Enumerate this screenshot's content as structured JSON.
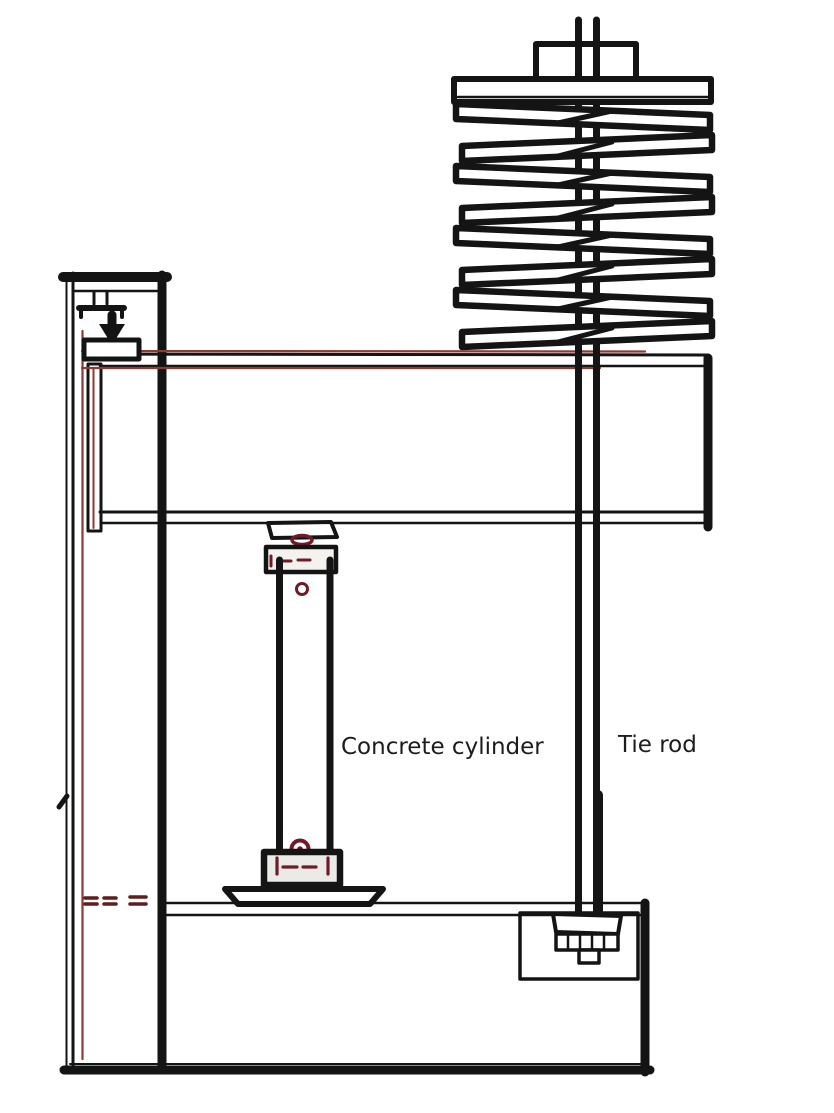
{
  "diagram": {
    "type": "engineering-sketch",
    "subject": "Creep test rig for a concrete cylinder with spring-loaded tie rod",
    "labels": {
      "concrete_cylinder": "Concrete cylinder",
      "tie_rod": "Tie rod"
    },
    "colors": {
      "ink": "#141414",
      "accent_red": "#701b28",
      "trace_red": "#8c3a36",
      "dash_red": "#5f1d1d",
      "cap_fill": "#edebe8",
      "background": "#ffffff"
    },
    "components": [
      "disc-spring-stack",
      "retaining-nut",
      "spring-top-plate",
      "tie-rod",
      "cross-beam",
      "reaction-column",
      "screw-jack",
      "load-arrow",
      "bearing-plate",
      "spherical-seat",
      "concrete-cylinder-specimen",
      "base-dish-plate",
      "base-frame",
      "anchor-nut-recess"
    ]
  }
}
